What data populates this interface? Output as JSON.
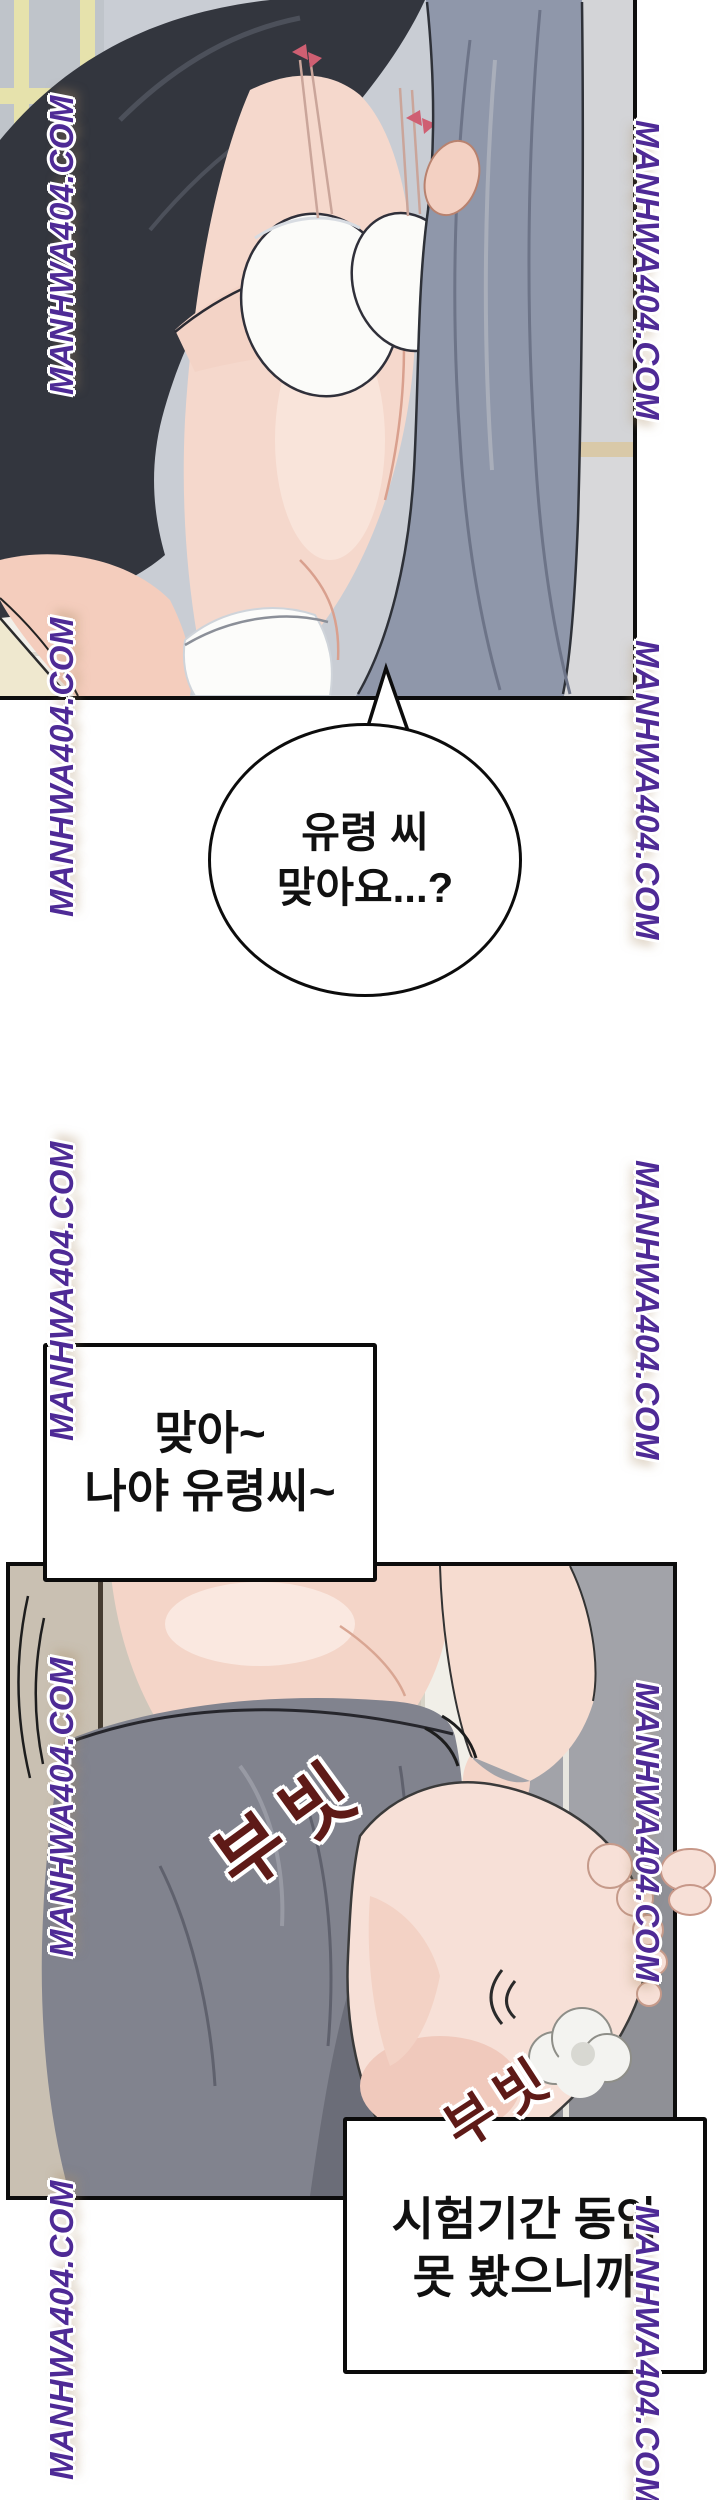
{
  "watermark": {
    "text": "MANHWA404.COM",
    "color": "#4e2a96"
  },
  "speech_bubble": {
    "line1": "유령 씨",
    "line2": "맞아요...?"
  },
  "mid_box": {
    "line1": "맞아~",
    "line2": "나야 유령씨~"
  },
  "bottom_box": {
    "line1": "시험기간 동안",
    "line2": "못 봤으니까"
  },
  "sfx": {
    "rub1": "부빗",
    "rub2": "부빗",
    "color": "#5e1a17"
  }
}
